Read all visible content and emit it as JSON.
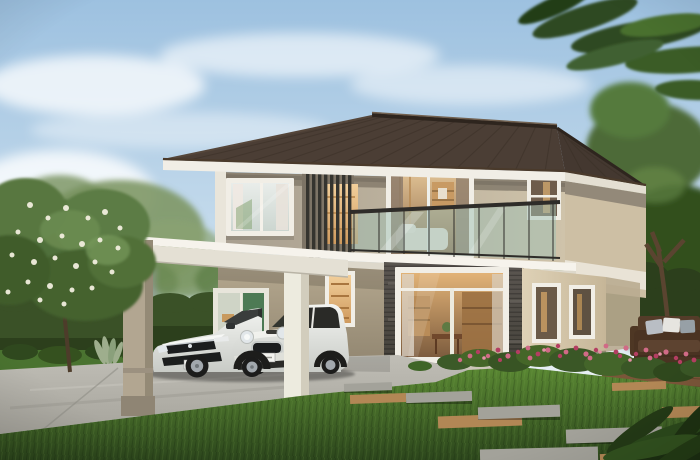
{
  "scene": {
    "objects": [
      "sky",
      "clouds",
      "background trees",
      "overhanging branch",
      "flowering tree",
      "hedges",
      "two-story house",
      "hip tile roof",
      "glass balcony",
      "louver screen",
      "carport",
      "white sedan",
      "white hatchback",
      "stone feature wall",
      "lit interior windows",
      "lawn",
      "driveway",
      "stepping stones",
      "gravel pads",
      "flower bed",
      "wood deck",
      "garden sofa"
    ]
  },
  "palette": {
    "sky_top": "#9dc1e0",
    "sky_mid": "#c8dded",
    "sky_horizon": "#ecf2f5",
    "cloud": "#ffffff",
    "roof": "#4b3e35",
    "roof_hip": "#443830",
    "roof_edge": "#2e251e",
    "fascia": "#f1eee6",
    "wall_taupe": "#8a8171",
    "wall_front": "#a79e8f",
    "wall_cream": "#cfc3aa",
    "wall_side": "#cdbfa4",
    "wall_shade_top": "#b6a990",
    "wall_shade_bot": "#8d826d",
    "trim_white": "#e9e5da",
    "stone_top": "#5b5651",
    "stone_bot": "#434038",
    "canopy": "#f3f0e9",
    "canopy_face": "#e4e0d4",
    "pillar_beige": "#b2a691",
    "pillar_white": "#edebdf",
    "window_frame": "#f1eee6",
    "glass_cool_top": "#e9edea",
    "glass_cool_bot": "#ccd6d0",
    "interior_warm_top": "#f2cf9b",
    "interior_warm_bot": "#cf9a5e",
    "living_top": "#e2b377",
    "living_bot": "#7d5c3e",
    "bedroom_top": "#dfc093",
    "bedroom_bot": "#8d6a49",
    "interior_green": "#4d7a54",
    "interior_wood": "#9c7142",
    "bed_white": "#eae4da",
    "curtain": "#8d7b6b",
    "balcony_glass": "#9fc0b4",
    "railing": "#2e2c29",
    "hedge": "#3a5127",
    "hedge_dark": "#2c3f1c",
    "tree_green": "#4e6b37",
    "tree_light": "#6f9350",
    "tree_dark": "#33501f",
    "frond": "#2f4a22",
    "blossom": "#f1eede",
    "grass_top": "#5a8833",
    "grass_bottom": "#2c461c",
    "grass_strip": "#4a7330",
    "driveway_far": "#c0beb6",
    "driveway": "#a5a39b",
    "paver_gray": "#a3a29a",
    "gravel_tan": "#b28755",
    "deck_wood": "#7b5639",
    "deck_dark": "#5f4028",
    "sofa_brown": "#4a3322",
    "pillow_gray": "#b9bec4",
    "pillow_white": "#e6e5e0",
    "pillow_slate": "#97a0a6",
    "flower_pink": "#d06a86",
    "flower_deep": "#b43e62",
    "flower_light": "#e490a6",
    "foliage": "#3c5a28",
    "trunk": "#5a4430",
    "car_body": "#f3f4f1",
    "car_body_shade": "#c8cbc6",
    "car_glass": "#33352f",
    "grille": "#1b1d1e",
    "chrome": "#c9ced2",
    "headlight": "#e2e7ea",
    "tire": "#1c1c1b",
    "rim": "#a2a8ad",
    "plate": "#f4f4f0"
  }
}
